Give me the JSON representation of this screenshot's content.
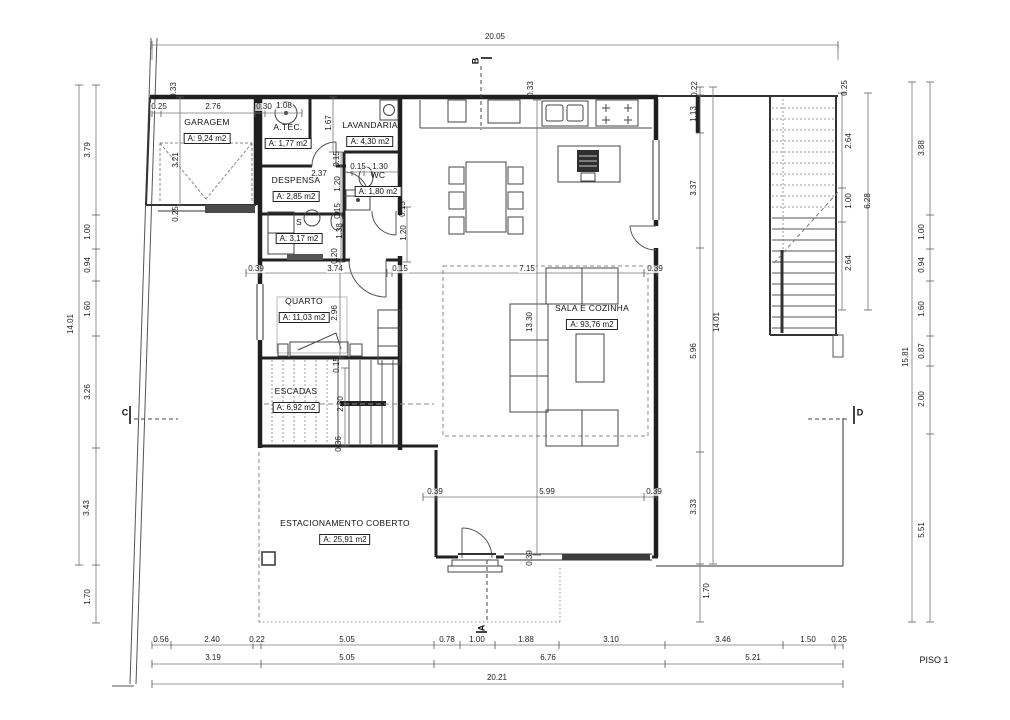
{
  "title": "PISO 1",
  "rooms": [
    {
      "name": "GARAGEM",
      "area": "A: 9,24 m2",
      "x": 207,
      "y": 126
    },
    {
      "name": "A.TEC.",
      "area": "A: 1,77 m2",
      "x": 288,
      "y": 131
    },
    {
      "name": "LAVANDARIA",
      "area": "A: 4,30 m2",
      "x": 370,
      "y": 129
    },
    {
      "name": "DESPENSA",
      "area": "A: 2,85 m2",
      "x": 296,
      "y": 184
    },
    {
      "name": "S",
      "area": "A: 3,17 m2",
      "x": 299,
      "y": 226
    },
    {
      "name": "WC",
      "area": "A: 1,80 m2",
      "x": 378,
      "y": 179
    },
    {
      "name": "QUARTO",
      "area": "A: 11,03 m2",
      "x": 304,
      "y": 305
    },
    {
      "name": "ESCADAS",
      "area": "A: 6,92 m2",
      "x": 296,
      "y": 395
    },
    {
      "name": "SALA E COZINHA",
      "area": "A: 93,76 m2",
      "x": 592,
      "y": 312
    },
    {
      "name": "ESTACIONAMENTO COBERTO",
      "area": "A: 25,91 m2",
      "x": 345,
      "y": 527
    }
  ],
  "section_markers": [
    {
      "t": "B",
      "x": 476,
      "y": 61,
      "r": 1
    },
    {
      "t": "A",
      "x": 482,
      "y": 628,
      "r": 1
    },
    {
      "t": "C",
      "x": 125,
      "y": 413
    },
    {
      "t": "D",
      "x": 860,
      "y": 413
    }
  ],
  "dim_labels": [
    {
      "t": "20.05",
      "x": 495,
      "y": 37
    },
    {
      "t": "0.25",
      "x": 159,
      "y": 107
    },
    {
      "t": "2.76",
      "x": 213,
      "y": 107
    },
    {
      "t": "0.30",
      "x": 264,
      "y": 107
    },
    {
      "t": "1.08",
      "x": 284,
      "y": 106
    },
    {
      "t": "0.33",
      "x": 174,
      "y": 90,
      "r": 1
    },
    {
      "t": "3.21",
      "x": 176,
      "y": 160,
      "r": 1
    },
    {
      "t": "0.25",
      "x": 176,
      "y": 214,
      "r": 1
    },
    {
      "t": "0.33",
      "x": 531,
      "y": 89,
      "r": 1
    },
    {
      "t": "0.25",
      "x": 845,
      "y": 88,
      "r": 1
    },
    {
      "t": "0.22",
      "x": 695,
      "y": 89,
      "r": 1
    },
    {
      "t": "1.13",
      "x": 694,
      "y": 114,
      "r": 1
    },
    {
      "t": "3.37",
      "x": 694,
      "y": 188,
      "r": 1
    },
    {
      "t": "5.96",
      "x": 694,
      "y": 351,
      "r": 1
    },
    {
      "t": "3.33",
      "x": 694,
      "y": 507,
      "r": 1
    },
    {
      "t": "1.70",
      "x": 707,
      "y": 591,
      "r": 1
    },
    {
      "t": "14.01",
      "x": 717,
      "y": 322,
      "r": 1
    },
    {
      "t": "3.79",
      "x": 88,
      "y": 150,
      "r": 1
    },
    {
      "t": "1.00",
      "x": 88,
      "y": 232,
      "r": 1
    },
    {
      "t": "0.94",
      "x": 88,
      "y": 265,
      "r": 1
    },
    {
      "t": "1.60",
      "x": 88,
      "y": 309,
      "r": 1
    },
    {
      "t": "3.26",
      "x": 88,
      "y": 392,
      "r": 1
    },
    {
      "t": "3.43",
      "x": 87,
      "y": 508,
      "r": 1
    },
    {
      "t": "1.70",
      "x": 88,
      "y": 597,
      "r": 1
    },
    {
      "t": "14.01",
      "x": 71,
      "y": 324,
      "r": 1
    },
    {
      "t": "3.88",
      "x": 922,
      "y": 148,
      "r": 1
    },
    {
      "t": "1.00",
      "x": 922,
      "y": 232,
      "r": 1
    },
    {
      "t": "0.94",
      "x": 922,
      "y": 265,
      "r": 1
    },
    {
      "t": "1.60",
      "x": 922,
      "y": 309,
      "r": 1
    },
    {
      "t": "0.87",
      "x": 922,
      "y": 351,
      "r": 1
    },
    {
      "t": "2.00",
      "x": 922,
      "y": 399,
      "r": 1
    },
    {
      "t": "5.51",
      "x": 922,
      "y": 530,
      "r": 1
    },
    {
      "t": "15.81",
      "x": 906,
      "y": 357,
      "r": 1
    },
    {
      "t": "2.64",
      "x": 849,
      "y": 141,
      "r": 1
    },
    {
      "t": "1.00",
      "x": 849,
      "y": 201,
      "r": 1
    },
    {
      "t": "2.64",
      "x": 849,
      "y": 263,
      "r": 1
    },
    {
      "t": "6.28",
      "x": 868,
      "y": 201,
      "r": 1
    },
    {
      "t": "1.67",
      "x": 329,
      "y": 123,
      "r": 1
    },
    {
      "t": "2.37",
      "x": 319,
      "y": 174
    },
    {
      "t": "0.15",
      "x": 358,
      "y": 167
    },
    {
      "t": "1.30",
      "x": 380,
      "y": 167
    },
    {
      "t": "0.15",
      "x": 337,
      "y": 159,
      "r": 1
    },
    {
      "t": "1.20",
      "x": 338,
      "y": 184,
      "r": 1
    },
    {
      "t": "0.15",
      "x": 338,
      "y": 211,
      "r": 1
    },
    {
      "t": "1.38",
      "x": 340,
      "y": 231,
      "r": 1
    },
    {
      "t": "0.20",
      "x": 335,
      "y": 256,
      "r": 1
    },
    {
      "t": "0.15",
      "x": 403,
      "y": 209,
      "r": 1
    },
    {
      "t": "1.20",
      "x": 404,
      "y": 233,
      "r": 1
    },
    {
      "t": "0.39",
      "x": 256,
      "y": 269
    },
    {
      "t": "3.74",
      "x": 335,
      "y": 269
    },
    {
      "t": "0.15",
      "x": 400,
      "y": 269
    },
    {
      "t": "7.15",
      "x": 527,
      "y": 269
    },
    {
      "t": "0.39",
      "x": 655,
      "y": 269
    },
    {
      "t": "2.96",
      "x": 335,
      "y": 313,
      "r": 1
    },
    {
      "t": "0.15",
      "x": 337,
      "y": 365,
      "r": 1
    },
    {
      "t": "2.30",
      "x": 341,
      "y": 404,
      "r": 1
    },
    {
      "t": "0.36",
      "x": 339,
      "y": 444,
      "r": 1
    },
    {
      "t": "13.30",
      "x": 530,
      "y": 322,
      "r": 1
    },
    {
      "t": "0.39",
      "x": 435,
      "y": 492
    },
    {
      "t": "5.99",
      "x": 547,
      "y": 492
    },
    {
      "t": "0.39",
      "x": 654,
      "y": 492
    },
    {
      "t": "0.39",
      "x": 530,
      "y": 558,
      "r": 1
    },
    {
      "t": "0.56",
      "x": 161,
      "y": 640
    },
    {
      "t": "2.40",
      "x": 212,
      "y": 640
    },
    {
      "t": "0.22",
      "x": 257,
      "y": 640
    },
    {
      "t": "5.05",
      "x": 347,
      "y": 640
    },
    {
      "t": "0.78",
      "x": 447,
      "y": 640
    },
    {
      "t": "1.00",
      "x": 477,
      "y": 640
    },
    {
      "t": "1.88",
      "x": 526,
      "y": 640
    },
    {
      "t": "3.10",
      "x": 611,
      "y": 640
    },
    {
      "t": "3.46",
      "x": 723,
      "y": 640
    },
    {
      "t": "1.50",
      "x": 808,
      "y": 640
    },
    {
      "t": "0.25",
      "x": 839,
      "y": 640
    },
    {
      "t": "3.19",
      "x": 213,
      "y": 658
    },
    {
      "t": "5.05",
      "x": 347,
      "y": 658
    },
    {
      "t": "6.76",
      "x": 548,
      "y": 658
    },
    {
      "t": "5.21",
      "x": 753,
      "y": 658
    },
    {
      "t": "20.21",
      "x": 497,
      "y": 678
    }
  ]
}
